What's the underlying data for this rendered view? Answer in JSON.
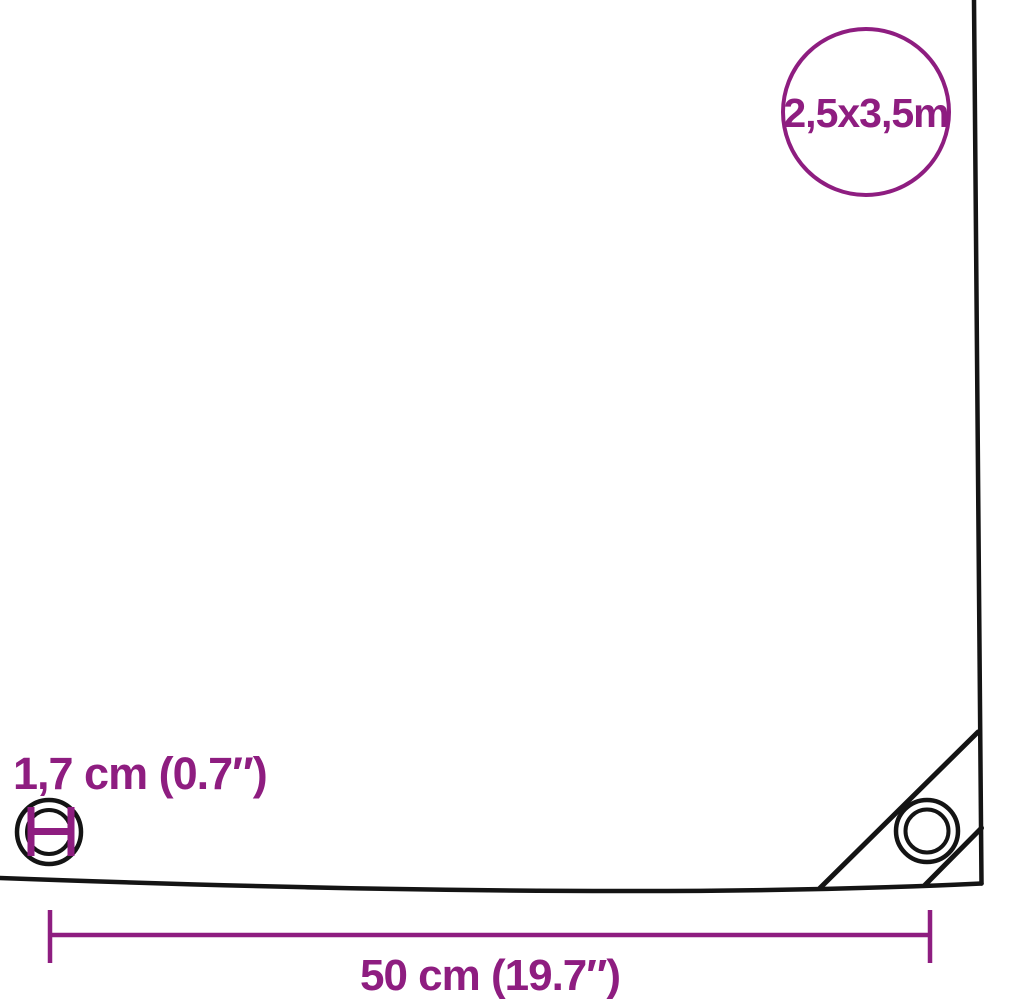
{
  "colors": {
    "accent": "#8e1d80",
    "ink": "#141414",
    "background": "#ffffff"
  },
  "badge": {
    "size_label": "2,5x3,5m"
  },
  "eyelet": {
    "diameter_label": "1,7 cm (0.7″)"
  },
  "dimension": {
    "spacing_label": "50 cm (19.7″)"
  },
  "icons": {
    "badge": "size-badge-circle",
    "front_eyelet": "eyelet-with-diameter-marker-icon",
    "corner_eyelet": "corner-eyelet-icon",
    "corner_patch": "corner-reinforcement-patch"
  }
}
